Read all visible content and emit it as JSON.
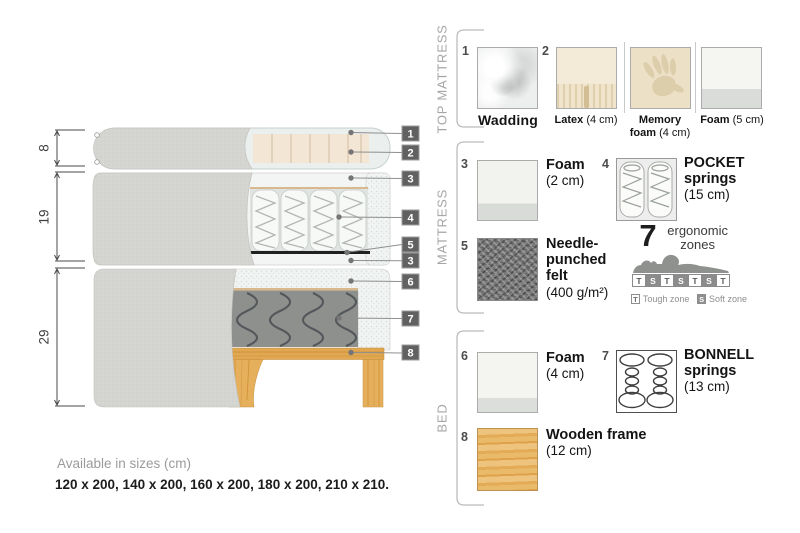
{
  "diagram": {
    "dimensions": [
      {
        "value": "8"
      },
      {
        "value": "19"
      },
      {
        "value": "29"
      }
    ],
    "tags": [
      {
        "n": "1"
      },
      {
        "n": "2"
      },
      {
        "n": "3"
      },
      {
        "n": "4"
      },
      {
        "n": "5"
      },
      {
        "n": "3"
      },
      {
        "n": "6"
      },
      {
        "n": "7"
      },
      {
        "n": "8"
      }
    ]
  },
  "legend": {
    "sections": [
      {
        "title": "TOP MATTRESS",
        "items": [
          {
            "num": "1",
            "name": "Wadding",
            "detail": "",
            "image": "wadding-swatch"
          },
          {
            "num": "2",
            "name": "Latex",
            "detail": "(4 cm)",
            "image": "latex-swatch"
          },
          {
            "num": "",
            "name": "Memory foam",
            "detail": "(4 cm)",
            "image": "memory-foam-swatch"
          },
          {
            "num": "",
            "name": "Foam",
            "detail": "(5 cm)",
            "image": "foam-swatch"
          }
        ]
      },
      {
        "title": "MATTRESS",
        "items": [
          {
            "num": "3",
            "name": "Foam",
            "detail": "(2 cm)",
            "image": "foam-swatch"
          },
          {
            "num": "4",
            "name": "POCKET springs",
            "detail": "(15 cm)",
            "image": "pocket-springs-drawing"
          },
          {
            "num": "5",
            "name": "Needle-punched felt",
            "detail": "(400 g/m²)",
            "image": "felt-swatch"
          }
        ],
        "zones": {
          "count": "7",
          "label": "ergonomic zones",
          "cells": [
            "T",
            "S",
            "T",
            "S",
            "T",
            "S",
            "T"
          ],
          "legend": [
            {
              "symbol": "T",
              "label": "Tough zone"
            },
            {
              "symbol": "S",
              "label": "Soft zone"
            }
          ]
        }
      },
      {
        "title": "BED",
        "items": [
          {
            "num": "6",
            "name": "Foam",
            "detail": "(4 cm)",
            "image": "foam-swatch"
          },
          {
            "num": "7",
            "name": "BONNELL springs",
            "detail": "(13 cm)",
            "image": "bonnell-springs-drawing"
          },
          {
            "num": "8",
            "name": "Wooden frame",
            "detail": "(12 cm)",
            "image": "wood-swatch"
          }
        ]
      }
    ]
  },
  "availability": {
    "title": "Available in sizes (cm)",
    "sizes": "120 x 200, 140 x 200, 160 x 200, 180 x 200, 210 x 210."
  },
  "palette": {
    "fabric_gray": "#d3d3d0",
    "cream": "#f3e6d4",
    "tan_line": "#d9b88c",
    "wood": "#e2a854",
    "felt_black": "#202020",
    "tag_gray": "#616161"
  }
}
